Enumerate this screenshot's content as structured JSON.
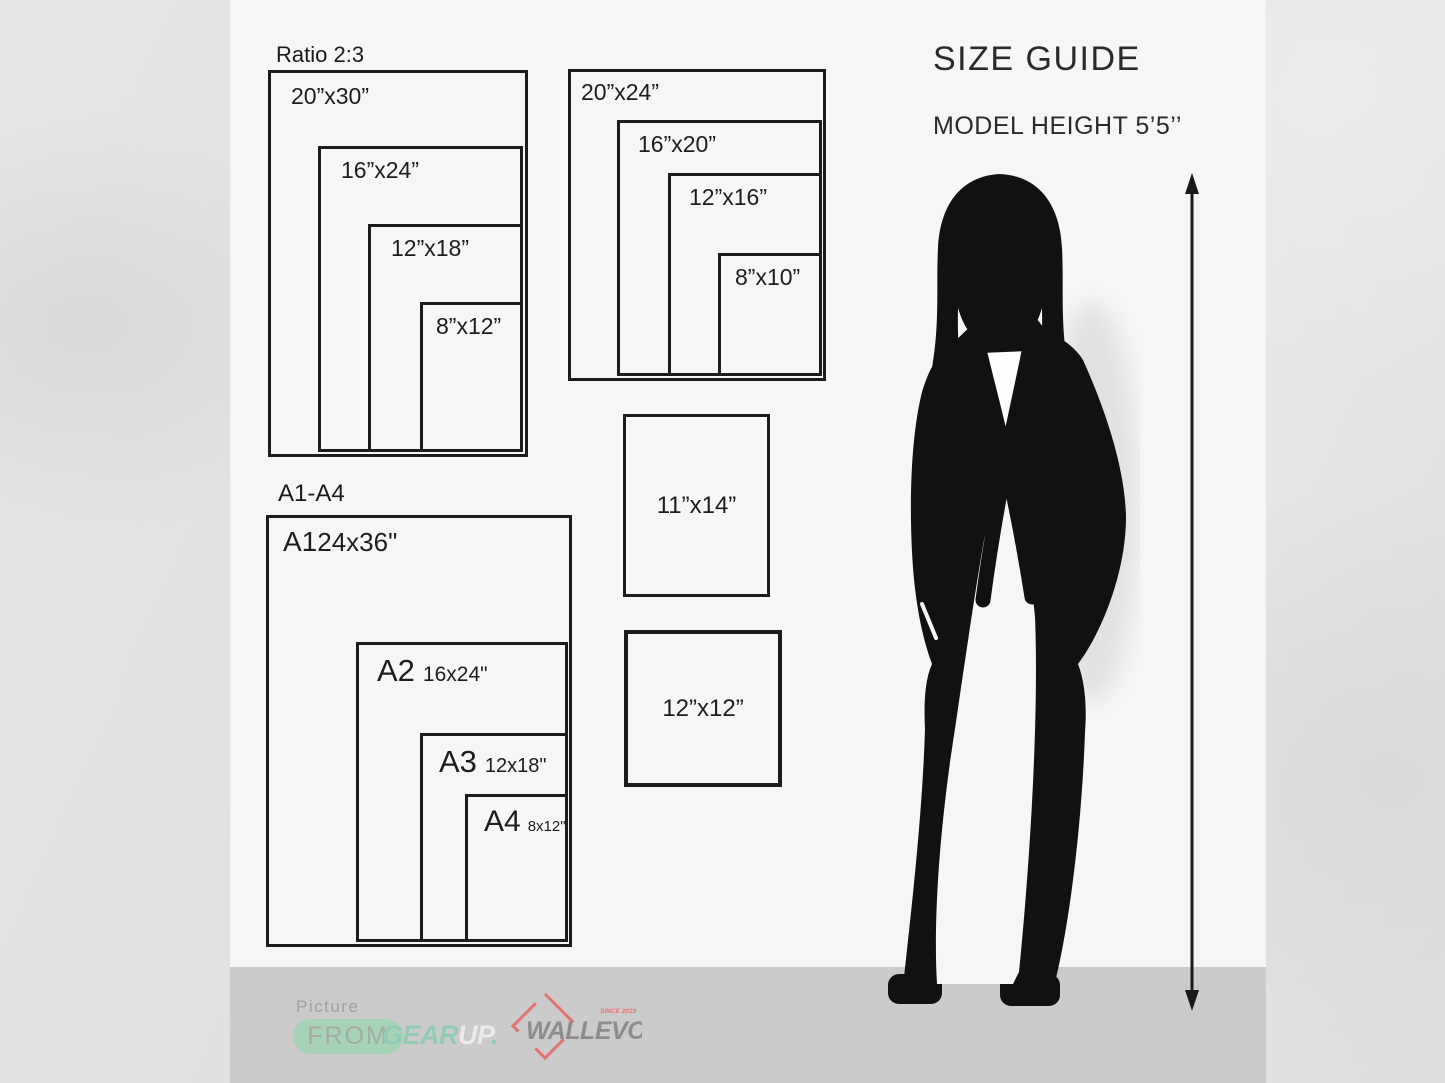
{
  "header": {
    "title": "SIZE GUIDE",
    "model_height": "MODEL HEIGHT 5’5’’"
  },
  "ratio_group": {
    "label": "Ratio 2:3",
    "sizes": [
      "20”x30”",
      "16”x24”",
      "12”x18”",
      "8”x12”"
    ]
  },
  "standard_group": {
    "sizes": [
      "20”x24”",
      "16”x20”",
      "12”x16”",
      "8”x10”"
    ]
  },
  "singles": {
    "sizes": [
      "11”x14”",
      "12”x12”"
    ]
  },
  "a_group": {
    "label": "A1-A4",
    "items": [
      {
        "name": "A1",
        "dim": "24x36\""
      },
      {
        "name": "A2",
        "dim": "16x24\""
      },
      {
        "name": "A3",
        "dim": "12x18\""
      },
      {
        "name": "A4",
        "dim": "8x12\""
      }
    ]
  },
  "footer": {
    "picture": "Picture",
    "from": "FROM",
    "gear": "GEAR",
    "up": "UP",
    "dot": ".",
    "brand": "WALLEVO",
    "since": "SINCE 2019"
  },
  "colors": {
    "line": "#1c1c1c",
    "content_bg": "#f6f6f5",
    "footer_bar": "#cbcbcb",
    "pill_green": "#a6d3b5",
    "mint": "#92cbb3",
    "brand_gray": "#8d8d8d",
    "diamond_red": "#e57272"
  }
}
